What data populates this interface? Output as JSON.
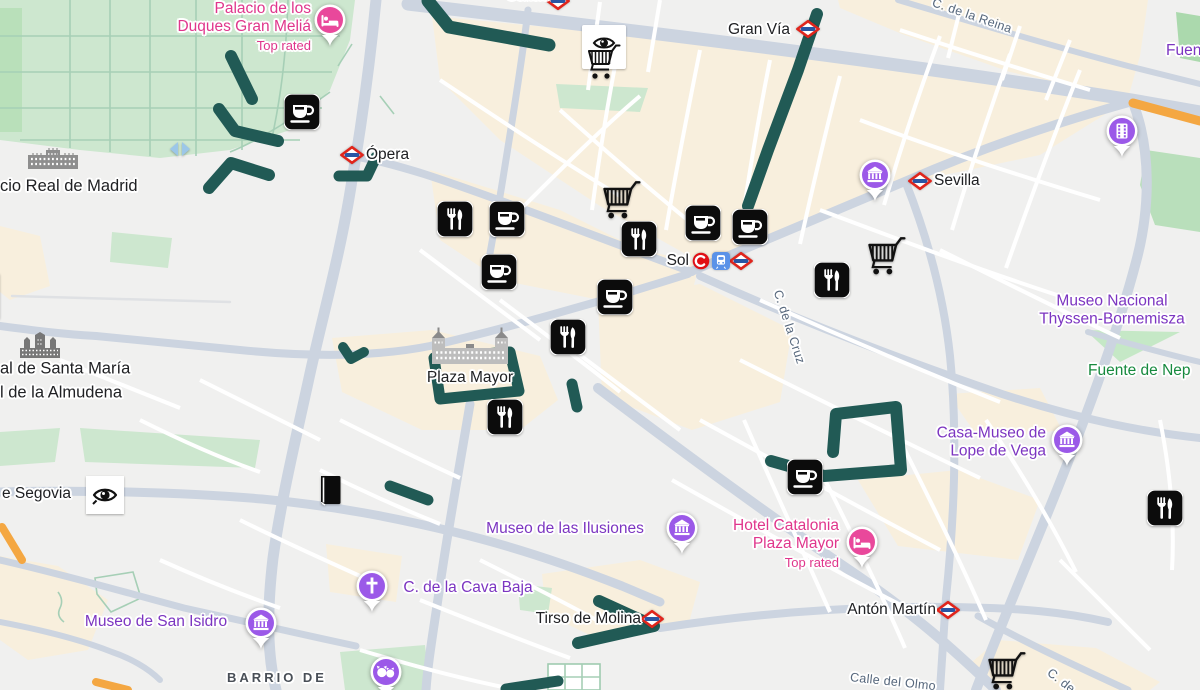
{
  "map": {
    "colors": {
      "route": "#215a55",
      "purple_pin": "#9b59e8",
      "pink_pin": "#e9489b",
      "metro_red": "#e0251c",
      "metro_blue": "#2a56a4",
      "cercanias_red": "#e10f14",
      "train_blue": "#5a92e8",
      "label_purple": "#7c35c1",
      "label_pink": "#e0368c",
      "label_green": "#178a3e",
      "label_black": "#202124",
      "label_street": "#56677c"
    },
    "misc": {
      "chevron_glyph": "›"
    },
    "labels": [
      {
        "name": "callao",
        "lines": [
          "Callao"
        ],
        "x": 528,
        "y": -4,
        "align": "center",
        "cls": "poi",
        "interactable": true
      },
      {
        "name": "gran-via",
        "lines": [
          "Gran Vía"
        ],
        "x": 790,
        "y": 30,
        "align": "right",
        "cls": "poi",
        "interactable": true
      },
      {
        "name": "opera",
        "lines": [
          "Ópera"
        ],
        "x": 366,
        "y": 155,
        "align": "left",
        "cls": "poi",
        "interactable": true
      },
      {
        "name": "sevilla",
        "lines": [
          "Sevilla"
        ],
        "x": 934,
        "y": 181,
        "align": "left",
        "cls": "poi",
        "interactable": true
      },
      {
        "name": "sol",
        "lines": [
          "Sol"
        ],
        "x": 689,
        "y": 261,
        "align": "right",
        "cls": "poi",
        "interactable": true
      },
      {
        "name": "plaza-mayor",
        "lines": [
          "Plaza Mayor"
        ],
        "x": 470,
        "y": 378,
        "align": "center",
        "cls": "poi",
        "interactable": true
      },
      {
        "name": "tirso-de-molina",
        "lines": [
          "Tirso de Molina"
        ],
        "x": 641,
        "y": 619,
        "align": "right",
        "cls": "poi",
        "interactable": true
      },
      {
        "name": "anton-martin",
        "lines": [
          "Antón Martín"
        ],
        "x": 936,
        "y": 610,
        "align": "right",
        "cls": "poi",
        "interactable": true
      },
      {
        "name": "segovia-fragment",
        "lines": [
          "e Segovia"
        ],
        "x": 2,
        "y": 494,
        "align": "left",
        "cls": "poi",
        "interactable": true
      },
      {
        "name": "palacio-real-fragment",
        "lines": [
          "cio Real de Madrid"
        ],
        "x": 0,
        "y": 186,
        "align": "left",
        "cls": "poi big",
        "interactable": true
      },
      {
        "name": "almudena-fragment",
        "lines": [
          "al de Santa María",
          "l de la Almudena"
        ],
        "x": 0,
        "y": 381,
        "align": "left",
        "cls": "poi big",
        "interactable": true
      },
      {
        "name": "barrio-la-latina",
        "lines": [
          "BARRIO DE",
          "LA LATINA"
        ],
        "x": 277,
        "y": 668,
        "align": "center",
        "anchor": "top",
        "cls": "neighborhood",
        "interactable": false
      },
      {
        "name": "palacio-duques",
        "lines": [
          "Palacio de los",
          "Duques Gran Meliá"
        ],
        "sub": "Top rated",
        "x": 311,
        "y": 0,
        "align": "right",
        "anchor": "top",
        "cls": "pink",
        "interactable": true
      },
      {
        "name": "thyssen",
        "lines": [
          "Museo Nacional",
          "Thyssen-Bornemisza"
        ],
        "x": 1112,
        "y": 311,
        "align": "center",
        "cls": "purple",
        "interactable": true
      },
      {
        "name": "fuente-neptuno-fragment",
        "lines": [
          "Fuente de Nep"
        ],
        "x": 1088,
        "y": 371,
        "align": "left",
        "cls": "green",
        "interactable": true
      },
      {
        "name": "lope-de-vega",
        "lines": [
          "Casa-Museo de",
          "Lope de Vega"
        ],
        "x": 1046,
        "y": 443,
        "align": "right",
        "cls": "purple",
        "interactable": true
      },
      {
        "name": "museo-ilusiones",
        "lines": [
          "Museo de las Ilusiones"
        ],
        "x": 565,
        "y": 529,
        "align": "center",
        "cls": "purple",
        "interactable": true
      },
      {
        "name": "hotel-catalonia",
        "lines": [
          "Hotel Catalonia",
          "Plaza Mayor"
        ],
        "sub": "Top rated",
        "x": 839,
        "y": 517,
        "align": "right",
        "anchor": "top",
        "cls": "pink",
        "interactable": true
      },
      {
        "name": "museo-san-isidro",
        "lines": [
          "Museo de San Isidro"
        ],
        "x": 156,
        "y": 622,
        "align": "center",
        "cls": "purple",
        "interactable": true
      },
      {
        "name": "cava-baja",
        "lines": [
          "C. de la Cava Baja"
        ],
        "x": 468,
        "y": 588,
        "align": "center",
        "cls": "purple",
        "interactable": true
      },
      {
        "name": "fuen-fragment",
        "lines": [
          "Fuen"
        ],
        "x": 1166,
        "y": 51,
        "align": "left",
        "cls": "purple",
        "interactable": true
      },
      {
        "name": "calle-reina",
        "lines": [
          "C. de la Reina"
        ],
        "x": 972,
        "y": 16,
        "align": "center",
        "cls": "street",
        "rot": 19,
        "interactable": false
      },
      {
        "name": "calle-cruz",
        "lines": [
          "C. de la Cruz"
        ],
        "x": 789,
        "y": 327,
        "align": "center",
        "cls": "street",
        "rot": 72,
        "interactable": false
      },
      {
        "name": "calle-olmo",
        "lines": [
          "Calle del Olmo"
        ],
        "x": 893,
        "y": 682,
        "align": "center",
        "cls": "street",
        "rot": 6,
        "interactable": false
      },
      {
        "name": "calle-de-fragment",
        "lines": [
          "C. de"
        ],
        "x": 1061,
        "y": 681,
        "align": "center",
        "cls": "street",
        "rot": 38,
        "interactable": false
      }
    ],
    "markers": [
      {
        "icon": "coffee",
        "x": 302,
        "y": 112
      },
      {
        "icon": "coffee",
        "x": 507,
        "y": 219
      },
      {
        "icon": "coffee",
        "x": 499,
        "y": 272
      },
      {
        "icon": "coffee",
        "x": 615,
        "y": 297
      },
      {
        "icon": "coffee",
        "x": 703,
        "y": 223
      },
      {
        "icon": "coffee",
        "x": 750,
        "y": 227
      },
      {
        "icon": "coffee",
        "x": 805,
        "y": 477
      },
      {
        "icon": "restaurant",
        "x": 455,
        "y": 219
      },
      {
        "icon": "restaurant",
        "x": 639,
        "y": 239
      },
      {
        "icon": "restaurant",
        "x": 568,
        "y": 337
      },
      {
        "icon": "restaurant",
        "x": 505,
        "y": 417
      },
      {
        "icon": "restaurant",
        "x": 832,
        "y": 280
      },
      {
        "icon": "restaurant",
        "x": 1165,
        "y": 508
      },
      {
        "icon": "cart",
        "x": 620,
        "y": 200
      },
      {
        "icon": "cart",
        "x": 885,
        "y": 256
      },
      {
        "icon": "cart",
        "x": 1005,
        "y": 671
      },
      {
        "icon": "cart-eye",
        "x": 604,
        "y": 54
      },
      {
        "icon": "book",
        "x": 330,
        "y": 490
      },
      {
        "icon": "eye",
        "x": 105,
        "y": 495
      },
      {
        "icon": "chevron",
        "x": -8,
        "y": 296
      },
      {
        "icon": "arrows",
        "x": 180,
        "y": 149
      }
    ],
    "pins": [
      {
        "icon": "museum",
        "color": "purple_pin",
        "x": 875,
        "y": 175
      },
      {
        "icon": "museum",
        "color": "purple_pin",
        "x": 1067,
        "y": 440
      },
      {
        "icon": "museum",
        "color": "purple_pin",
        "x": 682,
        "y": 528
      },
      {
        "icon": "museum",
        "color": "purple_pin",
        "x": 261,
        "y": 623
      },
      {
        "icon": "film",
        "color": "purple_pin",
        "x": 1122,
        "y": 131
      },
      {
        "icon": "church",
        "color": "purple_pin",
        "x": 372,
        "y": 586
      },
      {
        "icon": "pets",
        "color": "purple_pin",
        "x": 386,
        "y": 672
      },
      {
        "icon": "bed",
        "color": "pink_pin",
        "x": 330,
        "y": 20
      },
      {
        "icon": "bed",
        "color": "pink_pin",
        "x": 862,
        "y": 542
      }
    ],
    "transit": [
      {
        "icon": "metro",
        "x": 808,
        "y": 29
      },
      {
        "icon": "metro",
        "x": 352,
        "y": 155
      },
      {
        "icon": "metro",
        "x": 920,
        "y": 181
      },
      {
        "icon": "metro",
        "x": 741,
        "y": 261
      },
      {
        "icon": "metro",
        "x": 652,
        "y": 619
      },
      {
        "icon": "metro",
        "x": 948,
        "y": 610
      },
      {
        "icon": "metro",
        "x": 558,
        "y": 1
      },
      {
        "icon": "cercanias",
        "x": 701,
        "y": 261
      },
      {
        "icon": "train",
        "x": 721,
        "y": 261
      }
    ],
    "buildings": [
      {
        "icon": "palace",
        "x": 53,
        "y": 160
      },
      {
        "icon": "cathedral",
        "x": 40,
        "y": 347
      },
      {
        "icon": "plaza-building",
        "x": 470,
        "y": 349
      }
    ],
    "routes": [
      {
        "points": [
          [
            428,
            1
          ],
          [
            449,
            27
          ],
          [
            549,
            45
          ]
        ],
        "width": 13
      },
      {
        "points": [
          [
            231,
            56
          ],
          [
            252,
            99
          ]
        ],
        "width": 12
      },
      {
        "points": [
          [
            219,
            109
          ],
          [
            235,
            131
          ],
          [
            278,
            141
          ]
        ],
        "width": 12
      },
      {
        "points": [
          [
            209,
            188
          ],
          [
            231,
            163
          ],
          [
            269,
            175
          ]
        ],
        "width": 12
      },
      {
        "points": [
          [
            339,
            176
          ],
          [
            367,
            176
          ],
          [
            376,
            157
          ]
        ],
        "width": 11
      },
      {
        "points": [
          [
            817,
            14
          ],
          [
            798,
            70
          ],
          [
            768,
            150
          ],
          [
            748,
            206
          ]
        ],
        "width": 12
      },
      {
        "points": [
          [
            434,
            358
          ],
          [
            510,
            352
          ],
          [
            519,
            391
          ],
          [
            440,
            399
          ]
        ],
        "width": 11,
        "closed": true
      },
      {
        "points": [
          [
            572,
            384
          ],
          [
            577,
            407
          ]
        ],
        "width": 11
      },
      {
        "points": [
          [
            833,
            452
          ],
          [
            836,
            414
          ],
          [
            896,
            407
          ],
          [
            901,
            470
          ],
          [
            824,
            476
          ],
          [
            771,
            461
          ]
        ],
        "width": 12
      },
      {
        "points": [
          [
            599,
            601
          ],
          [
            654,
            626
          ],
          [
            578,
            643
          ]
        ],
        "width": 12
      },
      {
        "points": [
          [
            390,
            486
          ],
          [
            428,
            500
          ]
        ],
        "width": 11
      },
      {
        "points": [
          [
            343,
            347
          ],
          [
            351,
            359
          ],
          [
            364,
            352
          ]
        ],
        "width": 10
      },
      {
        "points": [
          [
            506,
            689
          ],
          [
            558,
            681
          ]
        ],
        "width": 11
      }
    ]
  }
}
